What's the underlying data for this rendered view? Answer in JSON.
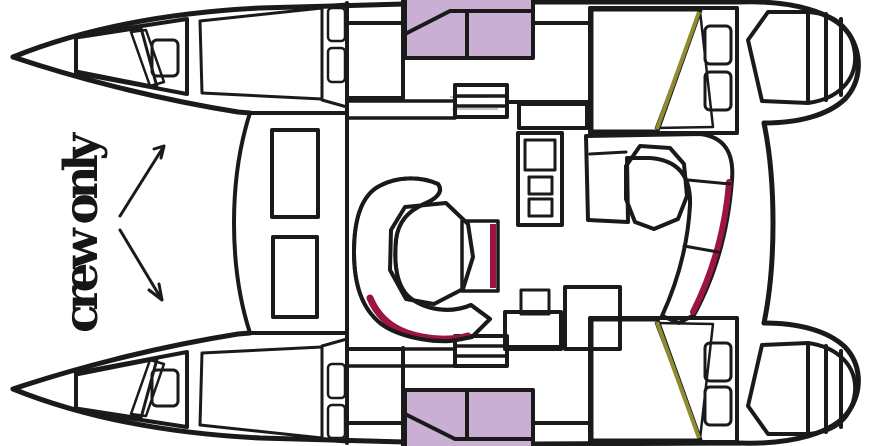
{
  "label": {
    "crew_only": "crew only"
  },
  "colors": {
    "background": "#ffffff",
    "outline": "#1a1a1a",
    "bed_gold": "#f5c42c",
    "bed_olive": "#b3ae3e",
    "bed_olive_dark": "#8f8b2e",
    "bed_fold": "#f2ee72",
    "sofa_pink": "#d02064",
    "sofa_pink_dark": "#9c1446",
    "cabin_purple": "#c9afd2",
    "table_gray": "#a8a8aa",
    "galley_gray": "#9b9b9d",
    "galley_gray_light": "#aeaeb0",
    "text_color": "#161616"
  }
}
